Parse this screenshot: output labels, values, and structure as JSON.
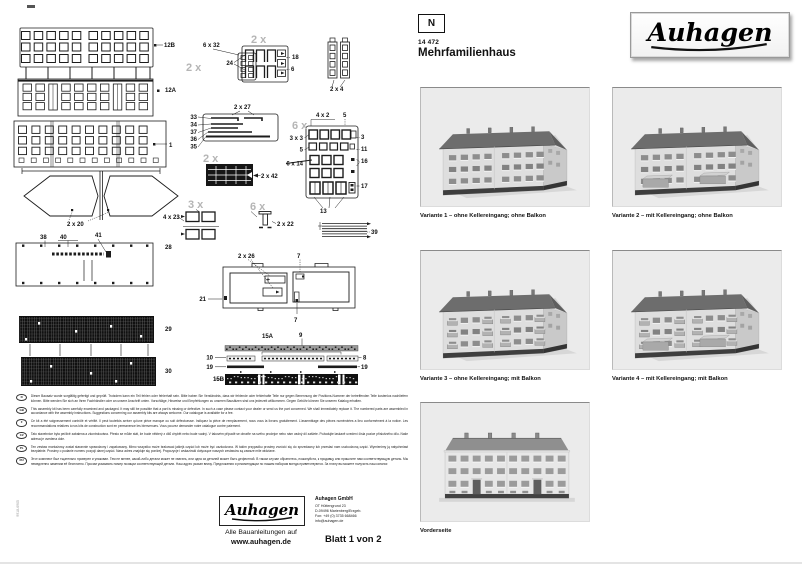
{
  "header": {
    "scale_badge": "N",
    "article_number": "14 472",
    "product_name": "Mehrfamilienhaus",
    "brand": "Auhagen"
  },
  "variants": [
    {
      "caption": "Variante 1 – ohne Kellereingang; ohne Balkon",
      "balcony": false,
      "cellar": false,
      "front": false
    },
    {
      "caption": "Variante 2 – mit Kellereingang; ohne Balkon",
      "balcony": false,
      "cellar": true,
      "front": false
    },
    {
      "caption": "Variante 3 – ohne Kellereingang; mit Balkon",
      "balcony": true,
      "cellar": false,
      "front": false
    },
    {
      "caption": "Variante 4 – mit Kellereingang; mit Balkon",
      "balcony": true,
      "cellar": true,
      "front": false
    },
    {
      "caption": "Vorderseite",
      "balcony": false,
      "cellar": false,
      "front": true
    }
  ],
  "footer": {
    "brand": "Auhagen",
    "tagline_line1": "Alle Bauanleitungen auf",
    "tagline_line2": "www.auhagen.de",
    "company": "Auhagen GmbH",
    "address": [
      "OT Hüttengrund 23",
      "D-09496 Marienberg/Erzgeb.",
      "Fon: +49 (0) 3735 668466",
      "info@auhagen.de"
    ],
    "sheet": "Blatt 1 von 2",
    "side_code": "9918-6905"
  },
  "notes": [
    {
      "code": "D",
      "text": "Dieser Bausatz wurde sorgfältig gefertigt und geprüft. Trotzdem kann ein Teil fehlen oder fehlerhaft sein. Bitte haben Sie Verständnis, dass wir fehlende oder fehlerhafte Teile nur gegen Benennung der Positions-Nummer der betreffenden Teile kostenlos nachliefern können. Bitte wenden Sie sich an Ihren Fachhändler oder an unsere Anschrift unten. Vorschläge, Hinweise und Empfehlungen zu unseren Bausätzen sind uns jederzeit willkommen. Gegen Gebühr können Sie unseren Katalog erhalten."
    },
    {
      "code": "GB",
      "text": "This assembly kit has been carefully examined and packaged. It may still be possible that a part is missing or defective. In such a case please contact your dealer or send us the part concerned. We shall immediately replace it. The numbered parts are assembled in accordance with the assembly instructions. Suggestions concerning our assembly kits are always welcome. Our catalogue is available for a fee."
    },
    {
      "code": "F",
      "text": "Ce kit a été soigneusement contrôlé et vérifié. Il peut toutefois arriver qu'une pièce manque ou soit défectueuse. Indiquez la pièce de remplacement, nous vous la livrons gratuitement. L'assemblage des pièces numérotées a lieu conformément à la notice. Les recommandations relatives à nos kits de construction sont en permanence les bienvenues. Vous pouvez demander notre catalogue contre paiement."
    },
    {
      "code": "CZ",
      "text": "Tato stavebnice byla pečlivě zabalena a zkontrolována. Přesto se může stát, že bude některý z dílů chybět nebo bude vadný. V takovém případě se obraťte na svého prodejce nebo nám vadný díl zašlete. Požadujte laskavě uvedení čísla pozice příslušného dílu. Naše adresa je uvedena dole."
    },
    {
      "code": "PL",
      "text": "Ten zestaw montażowy został starannie sprawdzony i zapakowany. Mimo wszystko może brakować jakiejś części lub może być uszkodzona. W takim przypadku prosimy zwrócić się do sprzedawcy lub przesłać nam uszkodzoną część. Wymienimy ją natychmiast bezpłatnie. Prosimy o podanie numeru pozycji danej części. Nasz adres znajduje się poniżej. Propozycje i wskazówki dotyczące naszych zestawów są zawsze mile widziane."
    },
    {
      "code": "RU",
      "text": "Этот комплект был тщательно проверен и упакован. Тем не менее, какой-либо детали может не хватать, или одна из деталей может быть дефектной. В таком случае обратитесь, пожалуйста, к продавцу или пришлите нам соответствующую деталь. Мы немедленно заменим её бесплатно. Просим указывать номер позиции соответствующей детали. Наш адрес указан внизу. Предложения и рекомендации по нашим наборам всегда приветствуются. За плату вы можете получить наш каталог."
    }
  ],
  "diagram": {
    "labels": [
      [
        164,
        47,
        "12B"
      ],
      [
        165,
        92,
        "12A"
      ],
      [
        169,
        147,
        "1"
      ],
      [
        67,
        226,
        "2 x 20"
      ],
      [
        163,
        219,
        "4 x 23"
      ],
      [
        40,
        239,
        "38"
      ],
      [
        60,
        239,
        "40"
      ],
      [
        95,
        237,
        "41"
      ],
      [
        165,
        249,
        "28"
      ],
      [
        165,
        331,
        "29"
      ],
      [
        165,
        373,
        "30"
      ],
      [
        203,
        47,
        "6 x 32"
      ],
      [
        233,
        65,
        "24",
        "end"
      ],
      [
        292,
        59,
        "18"
      ],
      [
        291,
        71,
        "6"
      ],
      [
        330,
        91,
        "2 x 4"
      ],
      [
        234,
        109,
        "2 x 27"
      ],
      [
        197,
        119,
        "33",
        "end"
      ],
      [
        197,
        126.5,
        "34",
        "end"
      ],
      [
        197,
        134,
        "37",
        "end"
      ],
      [
        197,
        141,
        "36",
        "end"
      ],
      [
        197,
        148.5,
        "35",
        "end"
      ],
      [
        316,
        117,
        "4 x 2"
      ],
      [
        343,
        117,
        "5"
      ],
      [
        303,
        140,
        "3 x 3",
        "end"
      ],
      [
        361,
        139,
        "3"
      ],
      [
        303,
        151.5,
        "5",
        "end"
      ],
      [
        361,
        151,
        "11"
      ],
      [
        303,
        165.5,
        "6 x 14",
        "end"
      ],
      [
        361,
        163,
        "16"
      ],
      [
        361,
        188,
        "17"
      ],
      [
        320,
        213,
        "13"
      ],
      [
        261,
        178,
        "2 x 42"
      ],
      [
        277,
        226,
        "2 x 22"
      ],
      [
        371,
        234,
        "39"
      ],
      [
        238,
        258,
        "2 x 26"
      ],
      [
        297,
        258,
        "7"
      ],
      [
        206,
        301,
        "21",
        "end"
      ],
      [
        294,
        322,
        "7"
      ],
      [
        262,
        338,
        "15A"
      ],
      [
        299,
        337,
        "9"
      ],
      [
        213,
        359.5,
        "10",
        "end"
      ],
      [
        363,
        359.5,
        "8"
      ],
      [
        213,
        369,
        "19",
        "end"
      ],
      [
        361,
        369,
        "19"
      ],
      [
        224,
        381,
        "15B",
        "end"
      ]
    ],
    "multipliers": [
      [
        186,
        71,
        "2 x"
      ],
      [
        251,
        43,
        "2 x"
      ],
      [
        292,
        129,
        "6 x"
      ],
      [
        203,
        162,
        "2 x"
      ],
      [
        188,
        208,
        "3 x"
      ],
      [
        250,
        210,
        "6 x"
      ]
    ]
  },
  "colors": {
    "line": "#1c1c1c",
    "multiplier_gray": "#b5b5b5",
    "panel_bg": "#ebebeb"
  }
}
